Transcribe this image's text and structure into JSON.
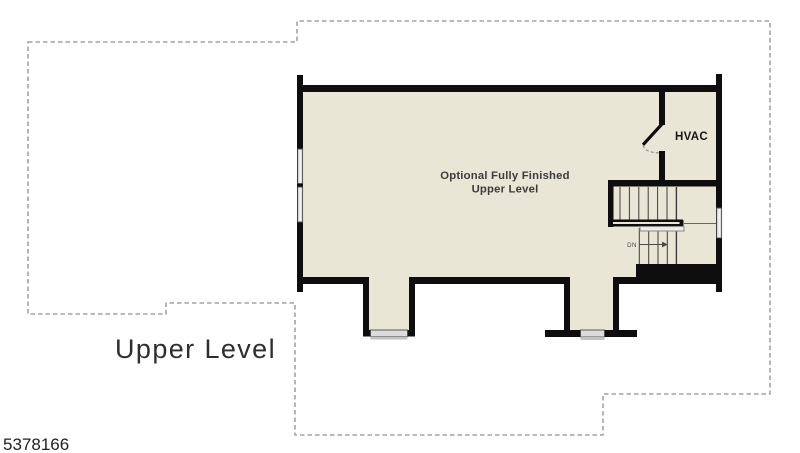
{
  "colors": {
    "floor": "#e9e6d6",
    "wall": "#0e0e0e",
    "window-fill": "#dcdcdc",
    "window-frame": "#4a4a4a",
    "window-sill": "#c2c2c2",
    "outline": "#a3a3a3",
    "tread": "#3c3c3c",
    "label": "#3b3b3b",
    "title": "#2e2e2e"
  },
  "plan": {
    "room_label_line1": "Optional Fully Finished",
    "room_label_line2": "Upper Level",
    "hvac_label": "HVAC",
    "stairs": {
      "direction_label": "DN"
    }
  },
  "footer": {
    "level_title": "Upper Level",
    "listing_number": "5378166"
  }
}
